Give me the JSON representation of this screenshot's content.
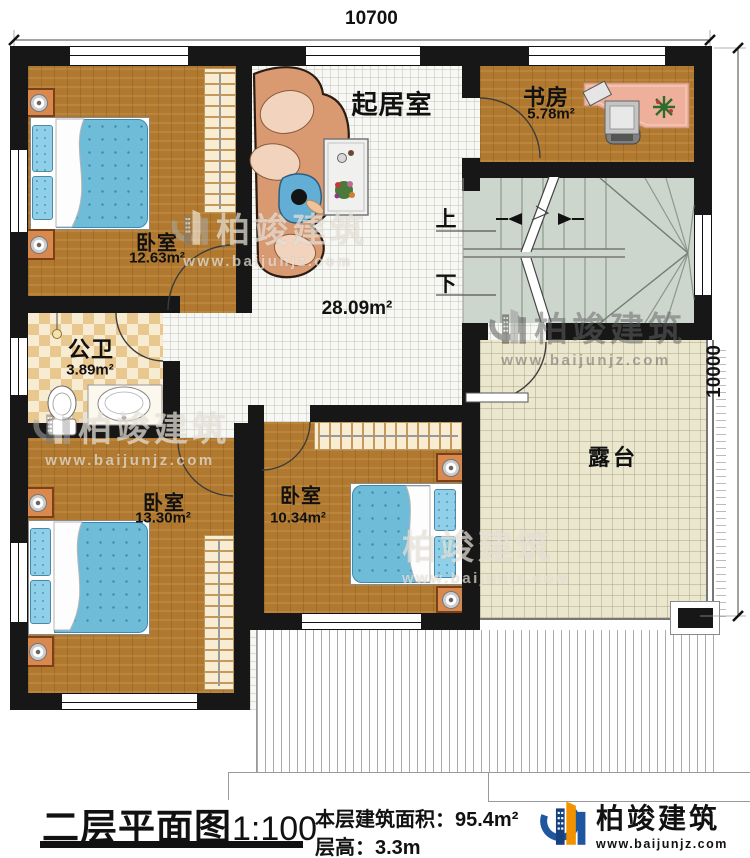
{
  "dimensions": {
    "top": "10700",
    "right": "10000"
  },
  "rooms": {
    "living": {
      "label": "起居室",
      "area": "28.09m²"
    },
    "study": {
      "label": "书房",
      "area": "5.78m²"
    },
    "bedroom1": {
      "label": "卧室",
      "area": "12.63m²"
    },
    "bathroom": {
      "label": "公卫",
      "area": "3.89m²"
    },
    "bedroom3": {
      "label": "卧室",
      "area": "13.30m²"
    },
    "bedroom2": {
      "label": "卧室",
      "area": "10.34m²"
    },
    "terrace": {
      "label": "露台"
    }
  },
  "stairs": {
    "up": "上",
    "down": "下"
  },
  "brand": {
    "name": "柏竣建筑",
    "url": "www.baijunjz.com"
  },
  "titleblock": {
    "title": "二层平面图",
    "scale": "1:100",
    "area_label": "本层建筑面积：",
    "area_value": "95.4m²",
    "floor_height_label": "层高：",
    "floor_height_value": "3.3m"
  }
}
